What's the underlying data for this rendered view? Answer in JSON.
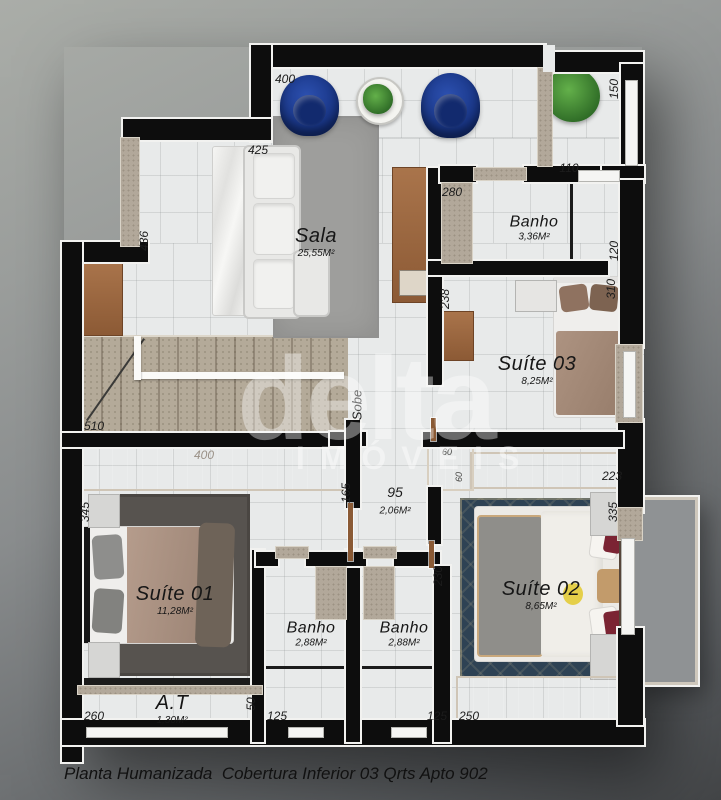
{
  "title": "Planta Humanizada  Cobertura Inferior 03 Qrts Apto 902",
  "watermark": {
    "brand": "delta",
    "subtitle": "IMÓVEIS"
  },
  "stairs": {
    "direction_label": "Sobe"
  },
  "rooms": {
    "sala": {
      "name": "Sala",
      "area": "25,55M²"
    },
    "banho_superior": {
      "name": "Banho",
      "area": "3,36M²"
    },
    "suite03": {
      "name": "Suíte 03",
      "area": "8,25M²"
    },
    "suite01": {
      "name": "Suíte 01",
      "area": "11,28M²"
    },
    "suite02": {
      "name": "Suíte 02",
      "area": "8,65M²"
    },
    "banho1": {
      "name": "Banho",
      "area": "2,88M²"
    },
    "banho2": {
      "name": "Banho",
      "area": "2,88M²"
    },
    "area_tecnica": {
      "name": "A.T",
      "area": "1,30M²"
    },
    "corredor": {
      "width": "95",
      "area": "2,06M²"
    }
  },
  "dimensions": {
    "sala_top": "400",
    "sala_sofa": "425",
    "sala_left": "436",
    "escada": "510",
    "suite01_left": "345",
    "suite01_bottom": "260",
    "at_height": "50",
    "guarda_roupa_suite01": "400",
    "guarda_roupa_altura": "165",
    "banho1_bottom": "125",
    "banho2_bottom": "125",
    "suite02_bottom": "250",
    "suite02_top": "223",
    "suite02_right": "335",
    "suite02_door": "230",
    "closet_largura": "60",
    "closet_altura": "60",
    "suite03_left": "238",
    "suite03_right": "310",
    "banho_sup_left": "280",
    "banho_sup_top": "110",
    "banho_sup_right": "120",
    "hall_right": "150"
  },
  "colors": {
    "wall": "#0d0d0d",
    "floor": "#e8eaea",
    "armchair_blue": "#1e3e94",
    "wood": "#9c6b45",
    "dark_wood": "#4a3a2f",
    "granite": "#b2a89a",
    "rug_sala": "#9c9c9a",
    "rug_suite01": "#57534f",
    "rug_suite02": "#2e4254",
    "bed_blanket_taupe": "#a68e7f",
    "pillow_red": "#7b2433",
    "background": "#8a8d8e"
  }
}
